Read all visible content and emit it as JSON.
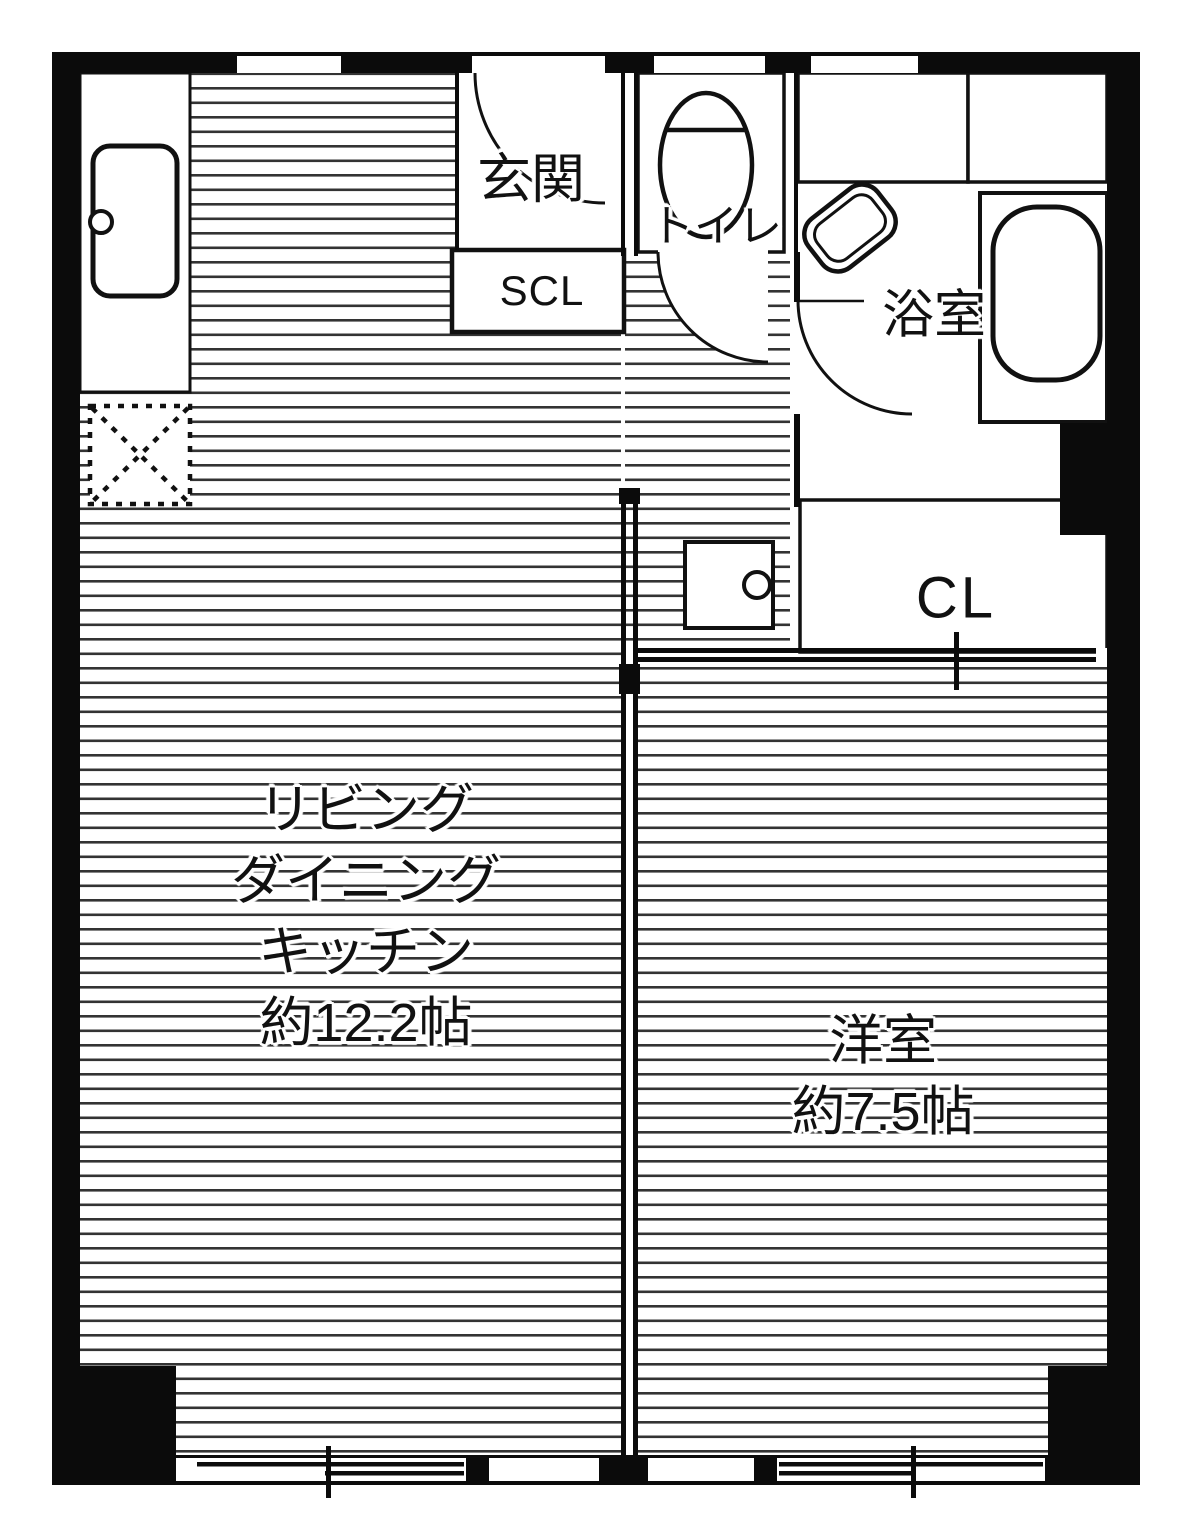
{
  "floorplan": {
    "colors": {
      "background": "#ffffff",
      "wall": "#0b0b0b",
      "floor_line": "#333333",
      "fixture_line": "#111111",
      "text": "#111111"
    },
    "rooms": {
      "entrance": {
        "label": "玄関"
      },
      "shoe_closet": {
        "label": "SCL"
      },
      "toilet": {
        "label": "トイレ"
      },
      "bathroom": {
        "label": "浴室"
      },
      "closet": {
        "label": "CL"
      },
      "ldk": {
        "label_lines": [
          "リビング",
          "ダイニング",
          "キッチン",
          "約12.2帖"
        ]
      },
      "western_room": {
        "label_lines": [
          "洋室",
          "約7.5帖"
        ]
      }
    },
    "fixtures": [
      "toilet-icon",
      "bathtub-icon",
      "washbasin-icon",
      "kitchen-sink-icon",
      "washing-machine-pan-icon",
      "refrigerator-space-icon"
    ]
  }
}
